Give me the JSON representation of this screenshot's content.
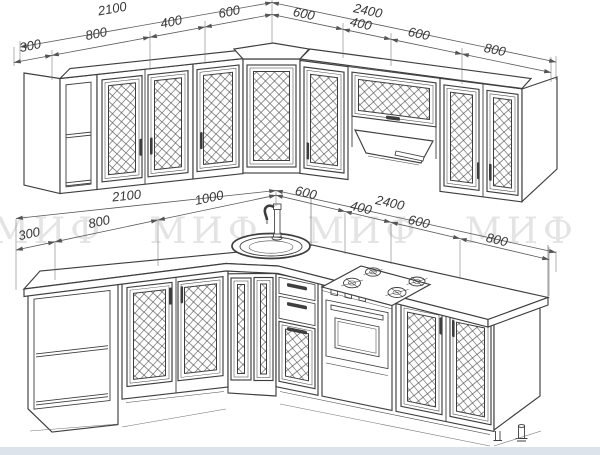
{
  "drawing": {
    "watermark": "МИФ МИФ МИФ МИФ МИФ",
    "upper_row": {
      "overall_left": "2100",
      "left_segments": [
        "300",
        "800",
        "400",
        "600"
      ],
      "overall_right": "2400",
      "right_segments": [
        "600",
        "400",
        "600",
        "800"
      ]
    },
    "lower_row": {
      "overall_left": "2100",
      "left_segments": [
        "300",
        "800",
        "1000"
      ],
      "overall_right": "2400",
      "right_segments": [
        "600",
        "400",
        "600",
        "800"
      ]
    },
    "colors": {
      "line": "#3e3e3e",
      "dimension": "#5a5a5a",
      "watermark": "#e4e4e4",
      "footer_band": "#dce3eb",
      "background": "#ffffff"
    }
  }
}
